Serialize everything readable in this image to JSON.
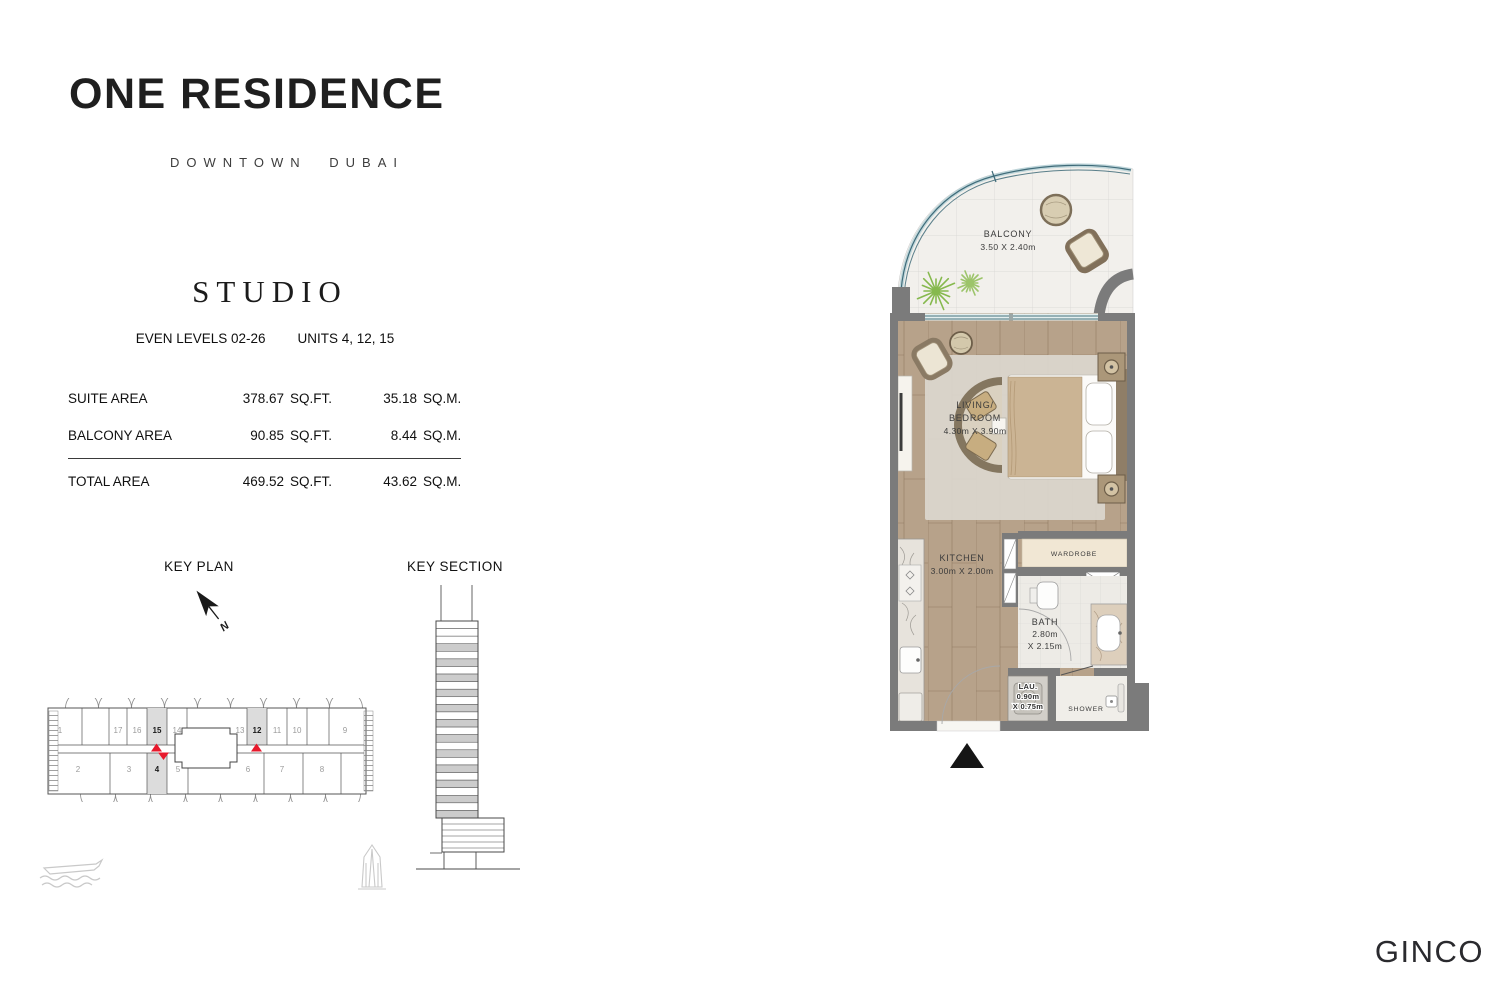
{
  "header": {
    "brand": "ONE RESIDENCE",
    "location": "DOWNTOWN DUBAI"
  },
  "unit_info": {
    "type_title": "STUDIO",
    "levels": "EVEN LEVELS 02-26",
    "units": "UNITS 4, 12, 15"
  },
  "areas": {
    "rows": [
      {
        "label": "SUITE AREA",
        "sqft_value": "378.67",
        "sqft_unit": "SQ.FT.",
        "sqm_value": "35.18",
        "sqm_unit": "SQ.M."
      },
      {
        "label": "BALCONY AREA",
        "sqft_value": "90.85",
        "sqft_unit": "SQ.FT.",
        "sqm_value": "8.44",
        "sqm_unit": "SQ.M."
      },
      {
        "label": "TOTAL AREA",
        "sqft_value": "469.52",
        "sqft_unit": "SQ.FT.",
        "sqm_value": "43.62",
        "sqm_unit": "SQ.M."
      }
    ]
  },
  "key_plan": {
    "title": "KEY PLAN",
    "north_label": "N",
    "top_row_units": [
      "1",
      "17",
      "16",
      "15",
      "14",
      "13",
      "12",
      "11",
      "10",
      "9"
    ],
    "bottom_row_units": [
      "2",
      "3",
      "4",
      "5",
      "6",
      "7",
      "8"
    ],
    "highlighted_units": [
      "4",
      "12",
      "15"
    ],
    "highlight_color": "#dcdcdc",
    "marker_color": "#e8192c"
  },
  "key_section": {
    "title": "KEY SECTION"
  },
  "floor_plan": {
    "rooms": {
      "balcony": {
        "label": "BALCONY",
        "dims": "3.50 X 2.40m"
      },
      "living": {
        "label_line1": "LIVING/",
        "label_line2": "BEDROOM",
        "dims": "4.30m X 3.90m"
      },
      "kitchen": {
        "label": "KITCHEN",
        "dims": "3.00m X 2.00m"
      },
      "wardrobe": {
        "label": "WARDROBE"
      },
      "bath": {
        "label": "BATH",
        "dims_line1": "2.80m",
        "dims_line2": "X 2.15m"
      },
      "laundry": {
        "label": "LAU.",
        "dims_line1": "0.90m",
        "dims_line2": "X 0.75m"
      },
      "shower": {
        "label": "SHOWER"
      }
    },
    "colors": {
      "wall": "#7b7b7b",
      "wood_floor": "#b7a28a",
      "balcony_floor": "#f2f0ec",
      "glass": "#3f6b79",
      "wardrobe_fill": "#f1e7d4"
    }
  },
  "footer": {
    "developer_logo": "GINCO"
  }
}
